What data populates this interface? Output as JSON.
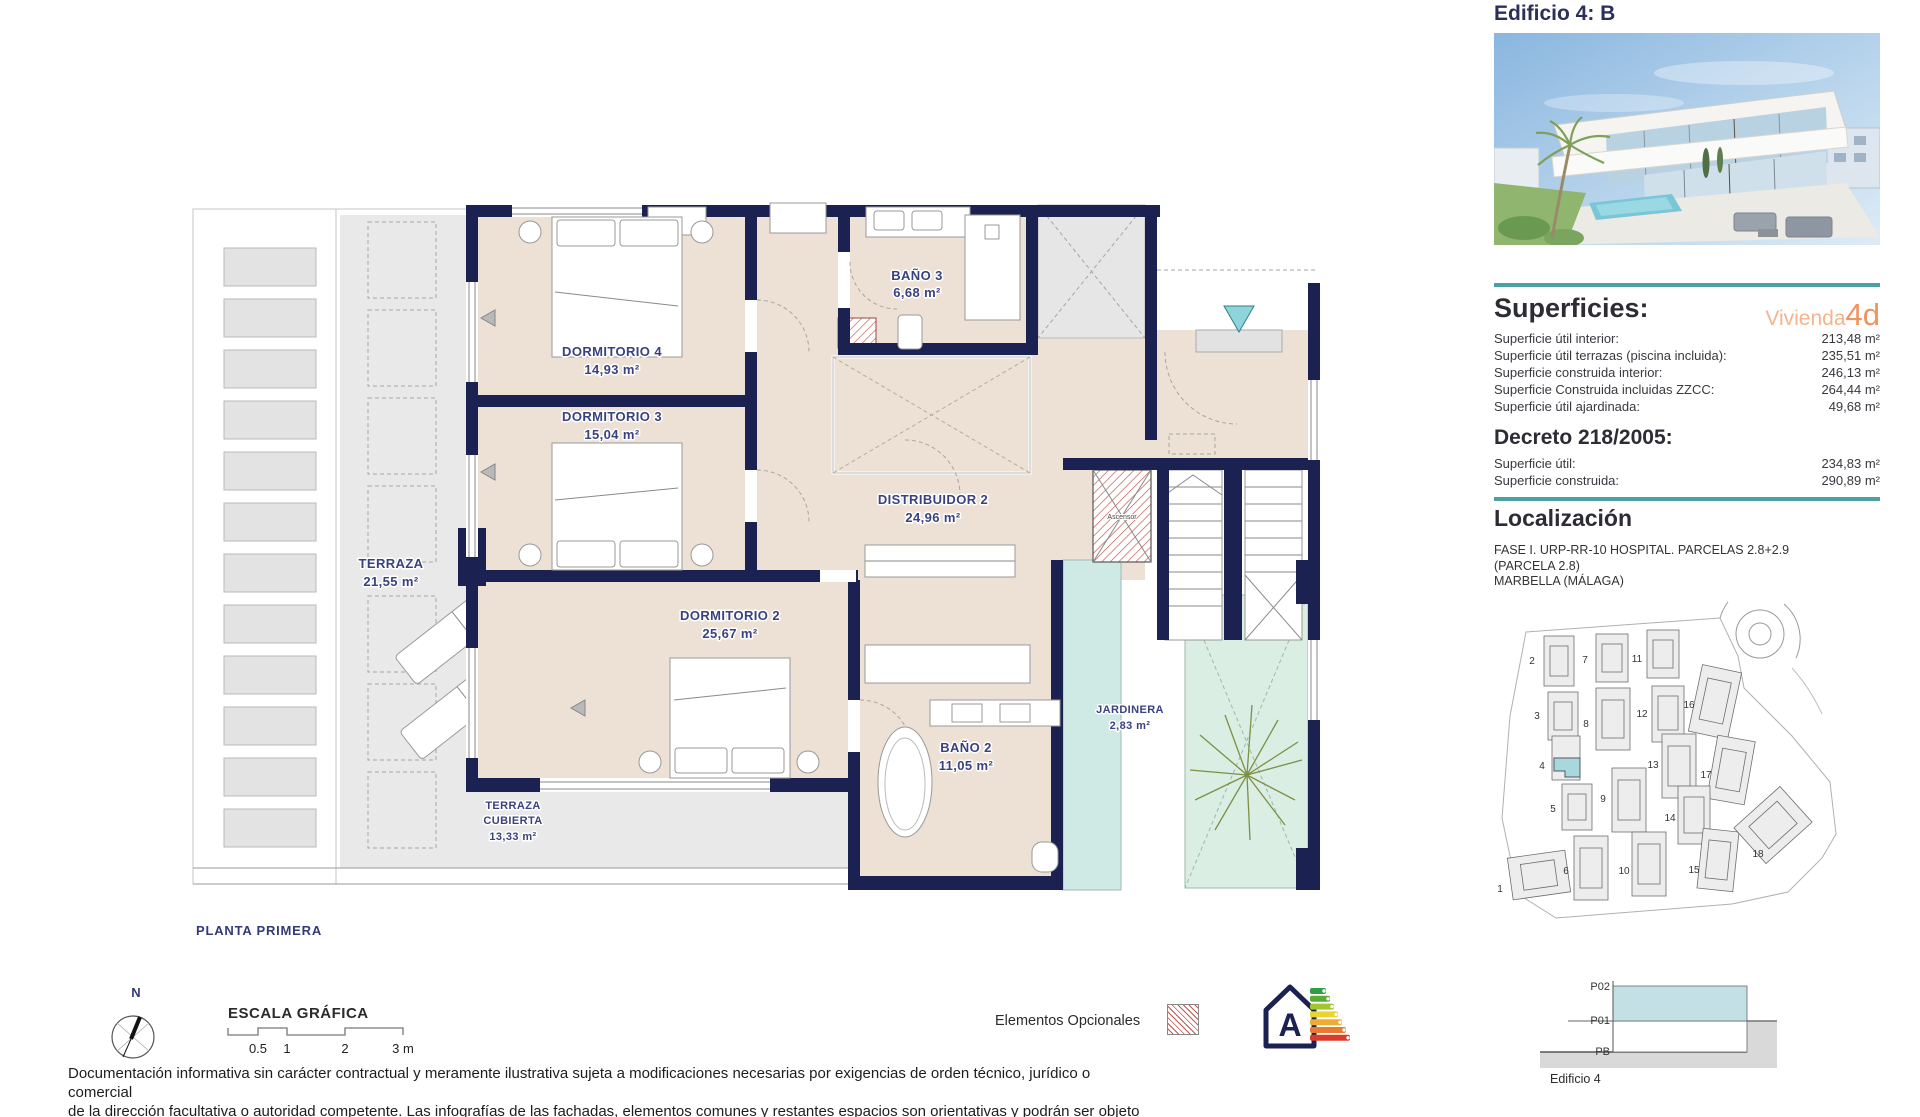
{
  "header": {
    "title": "Edificio 4: B"
  },
  "superficies": {
    "heading": "Superficies:",
    "vivienda_label": "Vivienda",
    "vivienda_code": "4d",
    "rows": [
      {
        "label": "Superficie útil interior:",
        "value": "213,48 m²"
      },
      {
        "label": "Superficie útil terrazas (piscina incluida):",
        "value": "235,51 m²"
      },
      {
        "label": "Superficie construida interior:",
        "value": "246,13 m²"
      },
      {
        "label": "Superficie Construida incluidas ZZCC:",
        "value": "264,44 m²"
      },
      {
        "label": "Superficie útil ajardinada:",
        "value": "49,68 m²"
      }
    ]
  },
  "decreto": {
    "heading": "Decreto 218/2005:",
    "rows": [
      {
        "label": "Superficie útil:",
        "value": "234,83 m²"
      },
      {
        "label": "Superficie construida:",
        "value": "290,89 m²"
      }
    ]
  },
  "localizacion": {
    "heading": "Localización",
    "lines": [
      "FASE I. URP-RR-10 HOSPITAL. PARCELAS 2.8+2.9",
      "(PARCELA 2.8)",
      "MARBELLA (MÁLAGA)"
    ]
  },
  "site_plan": {
    "numbers": [
      "1",
      "2",
      "3",
      "4",
      "5",
      "6",
      "7",
      "8",
      "9",
      "10",
      "11",
      "12",
      "13",
      "14",
      "15",
      "16",
      "17",
      "18"
    ]
  },
  "section": {
    "levels": [
      "P02",
      "P01",
      "PB"
    ],
    "caption": "Edificio 4"
  },
  "floor_plan": {
    "title": "PLANTA PRIMERA",
    "rooms": [
      {
        "name": "DORMITORIO 4",
        "area": "14,93 m²"
      },
      {
        "name": "DORMITORIO 3",
        "area": "15,04 m²"
      },
      {
        "name": "BAÑO 3",
        "area": "6,68 m²"
      },
      {
        "name": "DISTRIBUIDOR 2",
        "area": "24,96 m²"
      },
      {
        "name": "DORMITORIO 2",
        "area": "25,67 m²"
      },
      {
        "name": "BAÑO 2",
        "area": "11,05 m²"
      },
      {
        "name": "JARDINERA",
        "area": "2,83 m²"
      },
      {
        "name": "TERRAZA",
        "area": "21,55 m²"
      }
    ],
    "terraza_cubierta": {
      "line1": "TERRAZA",
      "line2": "CUBIERTA",
      "area": "13,33 m²"
    },
    "ascensor_label": "Ascensor",
    "h_marker": "H"
  },
  "compass": {
    "north": "N"
  },
  "scale_bar": {
    "title": "ESCALA GRÁFICA",
    "ticks": [
      "0.5",
      "1",
      "2",
      "3 m"
    ]
  },
  "legend": {
    "optional_label": "Elementos Opcionales",
    "energy_letter": "A"
  },
  "footer": {
    "lines": [
      "Documentación informativa sin carácter contractual y meramente ilustrativa sujeta a modificaciones necesarias por exigencias de orden técnico, jurídico o comercial",
      "de la dirección facultativa o autoridad competente. Las infografías de las fachadas, elementos comunes y restantes espacios son orientativas y podrán ser objeto de",
      "verificación o modificación en los proyectos técnicos. El mobiliario de las infografías interiores no está incluido, los acabados, calidades, colores, equipamiento,"
    ]
  },
  "colors": {
    "navy": "#1b2150",
    "teal_divider": "#4aa0a5",
    "orange": "#f0935f",
    "orange_light": "#f4b58d",
    "beige": "#ece1d4",
    "terrace_gray": "#e9e9e9",
    "mint_garden": "#daeee3",
    "jardinera_teal": "#cfe9e5",
    "entrance_triangle": "#8fd4da",
    "optional_hatch_red": "#c0564f"
  }
}
